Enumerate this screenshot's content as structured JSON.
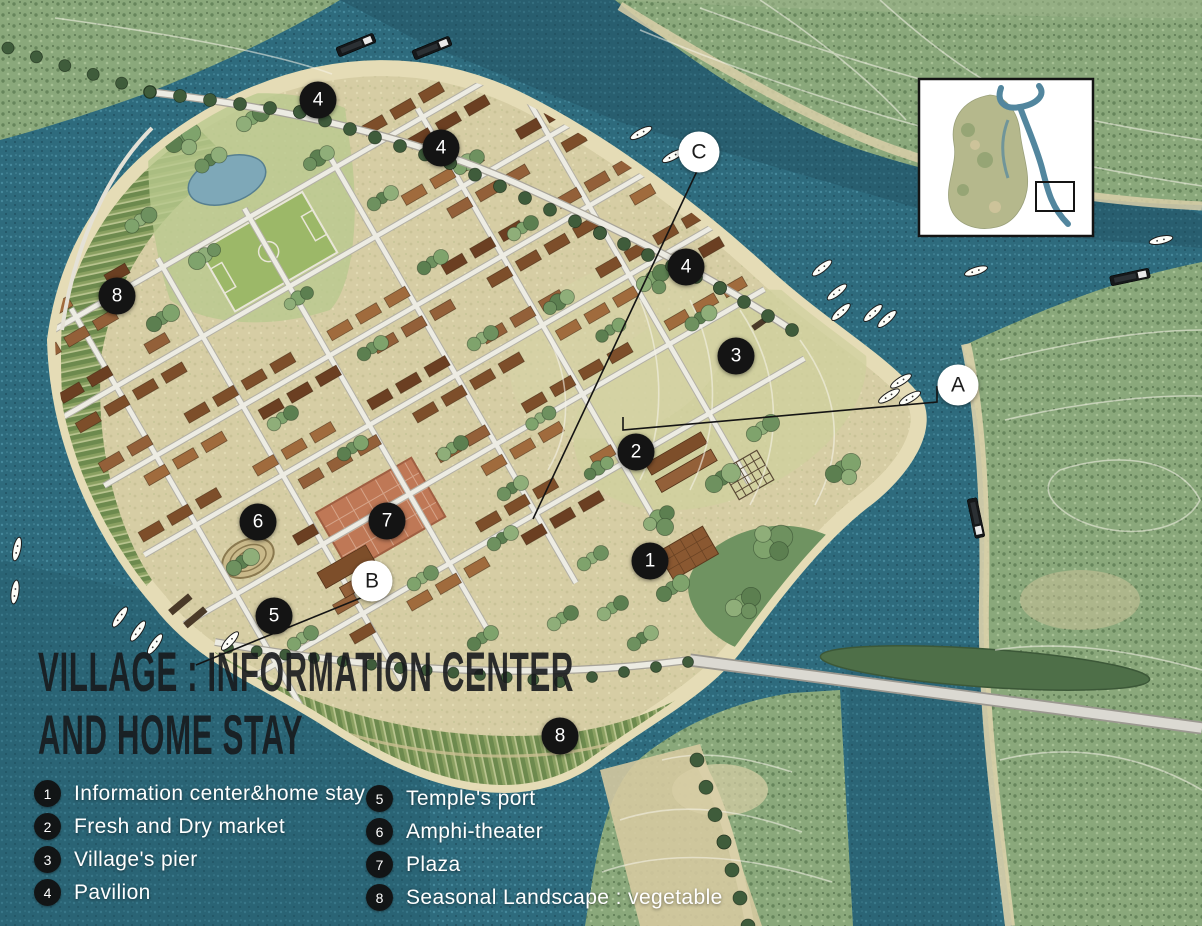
{
  "map_title": {
    "line1": "VILLAGE : INFORMATION CENTER",
    "line2": "AND HOME STAY"
  },
  "legend": {
    "columns": [
      {
        "items": [
          {
            "num": "1",
            "label": "Information center&home stay"
          },
          {
            "num": "2",
            "label": "Fresh and Dry market"
          },
          {
            "num": "3",
            "label": "Village's pier"
          },
          {
            "num": "4",
            "label": "Pavilion"
          }
        ]
      },
      {
        "items": [
          {
            "num": "5",
            "label": "Temple's port"
          },
          {
            "num": "6",
            "label": "Amphi-theater"
          },
          {
            "num": "7",
            "label": "Plaza"
          },
          {
            "num": "8",
            "label": "Seasonal Landscape : vegetable"
          }
        ]
      }
    ]
  },
  "markers": {
    "numbered": [
      {
        "label": "4",
        "x": 318,
        "y": 100
      },
      {
        "label": "4",
        "x": 441,
        "y": 148
      },
      {
        "label": "4",
        "x": 686,
        "y": 267
      },
      {
        "label": "3",
        "x": 736,
        "y": 356
      },
      {
        "label": "8",
        "x": 117,
        "y": 296
      },
      {
        "label": "2",
        "x": 636,
        "y": 452
      },
      {
        "label": "6",
        "x": 258,
        "y": 522
      },
      {
        "label": "7",
        "x": 387,
        "y": 521
      },
      {
        "label": "5",
        "x": 274,
        "y": 616
      },
      {
        "label": "1",
        "x": 650,
        "y": 561
      },
      {
        "label": "8",
        "x": 560,
        "y": 736
      }
    ],
    "lettered": [
      {
        "label": "C",
        "x": 699,
        "y": 152
      },
      {
        "label": "A",
        "x": 958,
        "y": 385
      },
      {
        "label": "B",
        "x": 372,
        "y": 581
      }
    ]
  },
  "leader_lines": [
    {
      "name": "leader-to-C",
      "points": [
        [
          697,
          171
        ],
        [
          533,
          519
        ]
      ]
    },
    {
      "name": "leader-to-B",
      "points": [
        [
          368,
          595
        ],
        [
          196,
          665
        ]
      ]
    },
    {
      "name": "leader-to-A",
      "points": [
        [
          623,
          417
        ],
        [
          623,
          430
        ],
        [
          937,
          402
        ],
        [
          937,
          386
        ]
      ]
    }
  ],
  "colors": {
    "water": "#2e6b7d",
    "water_deep": "#214f5f",
    "island_ground": "#d6cda4",
    "forest": "#8aa87b",
    "building_brown": "#7d4e2a",
    "marker_black": "#141414",
    "marker_white": "#ffffff",
    "legend_text": "#ffffff",
    "title_text": "#171a1d"
  }
}
